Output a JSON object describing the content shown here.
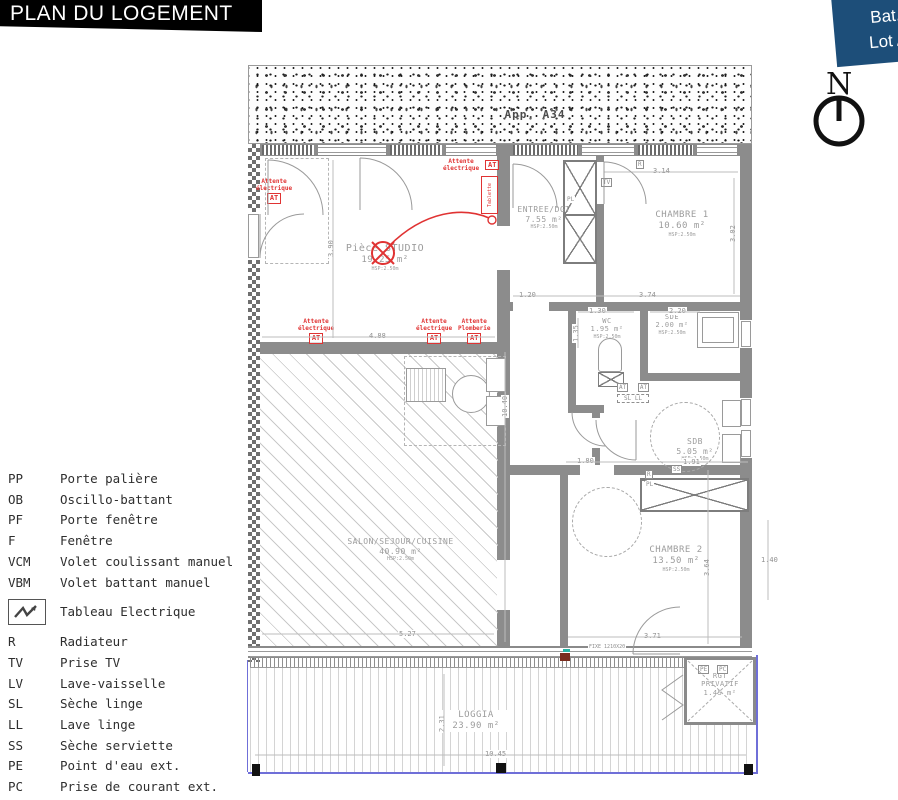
{
  "header": {
    "title": "PLAN DU LOGEMENT"
  },
  "badge": {
    "line1": "Bat. A",
    "line2": "Lot A 3"
  },
  "compass": {
    "label": "N"
  },
  "neighbor": {
    "label": "App. A34"
  },
  "colors": {
    "accent_red": "#e03333",
    "badge_blue": "#1d4e79",
    "boundary_purple": "#6f6fd8"
  },
  "legend": {
    "items": [
      {
        "abbr": "PP",
        "label": "Porte palière"
      },
      {
        "abbr": "OB",
        "label": "Oscillo-battant"
      },
      {
        "abbr": "PF",
        "label": "Porte fenêtre"
      },
      {
        "abbr": "F",
        "label": "Fenêtre"
      },
      {
        "abbr": "VCM",
        "label": "Volet coulissant manuel"
      },
      {
        "abbr": "VBM",
        "label": "Volet battant manuel"
      }
    ],
    "electric": {
      "label": "Tableau Electrique"
    },
    "items2": [
      {
        "abbr": "R",
        "label": "Radiateur"
      },
      {
        "abbr": "TV",
        "label": "Prise TV"
      },
      {
        "abbr": "LV",
        "label": "Lave-vaisselle"
      },
      {
        "abbr": "SL",
        "label": "Sèche linge"
      },
      {
        "abbr": "LL",
        "label": "Lave linge"
      },
      {
        "abbr": "SS",
        "label": "Sèche serviette"
      },
      {
        "abbr": "PE",
        "label": "Point d'eau ext."
      },
      {
        "abbr": "PC",
        "label": "Prise de courant ext."
      }
    ]
  },
  "rooms": {
    "studio": {
      "name": "Pièce STUDIO",
      "area": "19.25 m²",
      "hsp": "HSP:2.50m"
    },
    "entree": {
      "name": "ENTREE/DGT",
      "area": "7.55 m²",
      "hsp": "HSP:2.50m"
    },
    "chambre1": {
      "name": "CHAMBRE 1",
      "area": "10.60 m²",
      "hsp": "HSP:2.50m"
    },
    "wc": {
      "name": "WC",
      "area": "1.95 m²",
      "hsp": "HSP:2.50m"
    },
    "sde": {
      "name": "SDE",
      "area": "2.00 m²",
      "hsp": "HSP:2.50m"
    },
    "sdb": {
      "name": "SDB",
      "area": "5.05 m²",
      "hsp": "HSP:2.50m"
    },
    "chambre2": {
      "name": "CHAMBRE 2",
      "area": "13.50 m²",
      "hsp": "HSP:2.50m"
    },
    "salon": {
      "name": "SALON/SEJOUR/CUISINE",
      "area": "40.90 m²",
      "hsp": "HSP:2.50m"
    },
    "loggia": {
      "name": "LOGGIA",
      "area": "23.90 m²"
    },
    "rgt": {
      "line1": "RGT",
      "line2": "PRIVATIF",
      "area": "1.45 m²"
    }
  },
  "annotations": {
    "att_left": {
      "line1": "Attente",
      "line2": "électrique",
      "tag": "AT"
    },
    "att_topright": {
      "line1": "Attente",
      "line2": "électrique",
      "tag": "AT"
    },
    "tablette": {
      "label": "Tablette"
    },
    "att_bottom1": {
      "line1": "Attente",
      "line2": "électrique",
      "tag": "AT"
    },
    "att_bottom2": {
      "line1": "Attente",
      "line2": "électrique",
      "tag": "AT"
    },
    "att_bottom3": {
      "line1": "Attente",
      "line2": "Plomberie",
      "tag": "AT"
    }
  },
  "fixtures": {
    "tv": "TV",
    "r1": "R",
    "r2": "R",
    "pl1": "PL",
    "pl2": "PL",
    "ss": "SS",
    "pe": "PE",
    "pc": "PC",
    "at1": "AT",
    "at2": "AT",
    "sl_ll": "SL LL",
    "fixe": "FIXE 1210X20"
  },
  "dims": {
    "studio_w": "4.88",
    "studio_h": "3.90",
    "hall": "1.20",
    "ch1_w": "3.74",
    "ch1_top": "3.14",
    "ch1_h": "3.02",
    "wc_w": "1.30",
    "wc_h": "1.35",
    "sde_w": "2.20",
    "sdb_l": "1.80",
    "sdb_w": "1.91",
    "ch2_h": "3.64",
    "ch2_w": "3.71",
    "total_h": "10.40",
    "loggia_w": "10.45",
    "loggia_h": "2.31",
    "right": "1.40",
    "salon_w": "5.27"
  }
}
